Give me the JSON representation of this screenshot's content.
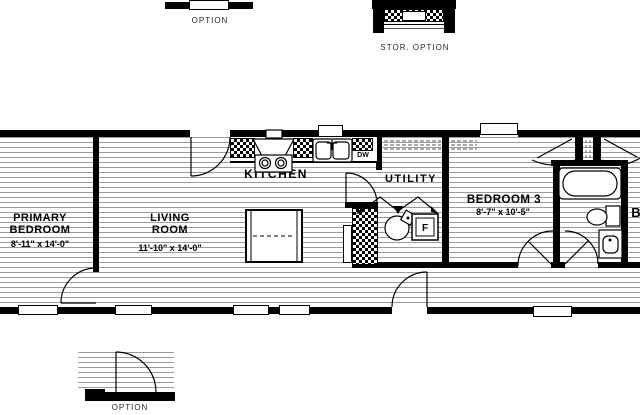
{
  "details": {
    "window_option": {
      "label": "OPTION"
    },
    "storage_option": {
      "label": "STOR.  OPTION"
    },
    "door_option": {
      "label": "OPTION"
    }
  },
  "rooms": {
    "primary_bedroom": {
      "name_line1": "PRIMARY",
      "name_line2": "BEDROOM",
      "dims": "8'-11\" x 14'-0\""
    },
    "living_room": {
      "name_line1": "LIVING",
      "name_line2": "ROOM",
      "dims": "11'-10\" x 14'-0\""
    },
    "kitchen": {
      "name": "KITCHEN"
    },
    "utility": {
      "name": "UTILITY"
    },
    "bedroom_3": {
      "name": "BEDROOM 3",
      "dims": "8'-7\" x 10'-5\""
    },
    "adjacent_bedroom_partial": {
      "name": "B"
    }
  },
  "appliances": {
    "dishwasher": "DW",
    "furnace": "F"
  },
  "colors": {
    "wall": "#000000",
    "hatch_line": "#9b9b9b",
    "background": "#ffffff"
  }
}
